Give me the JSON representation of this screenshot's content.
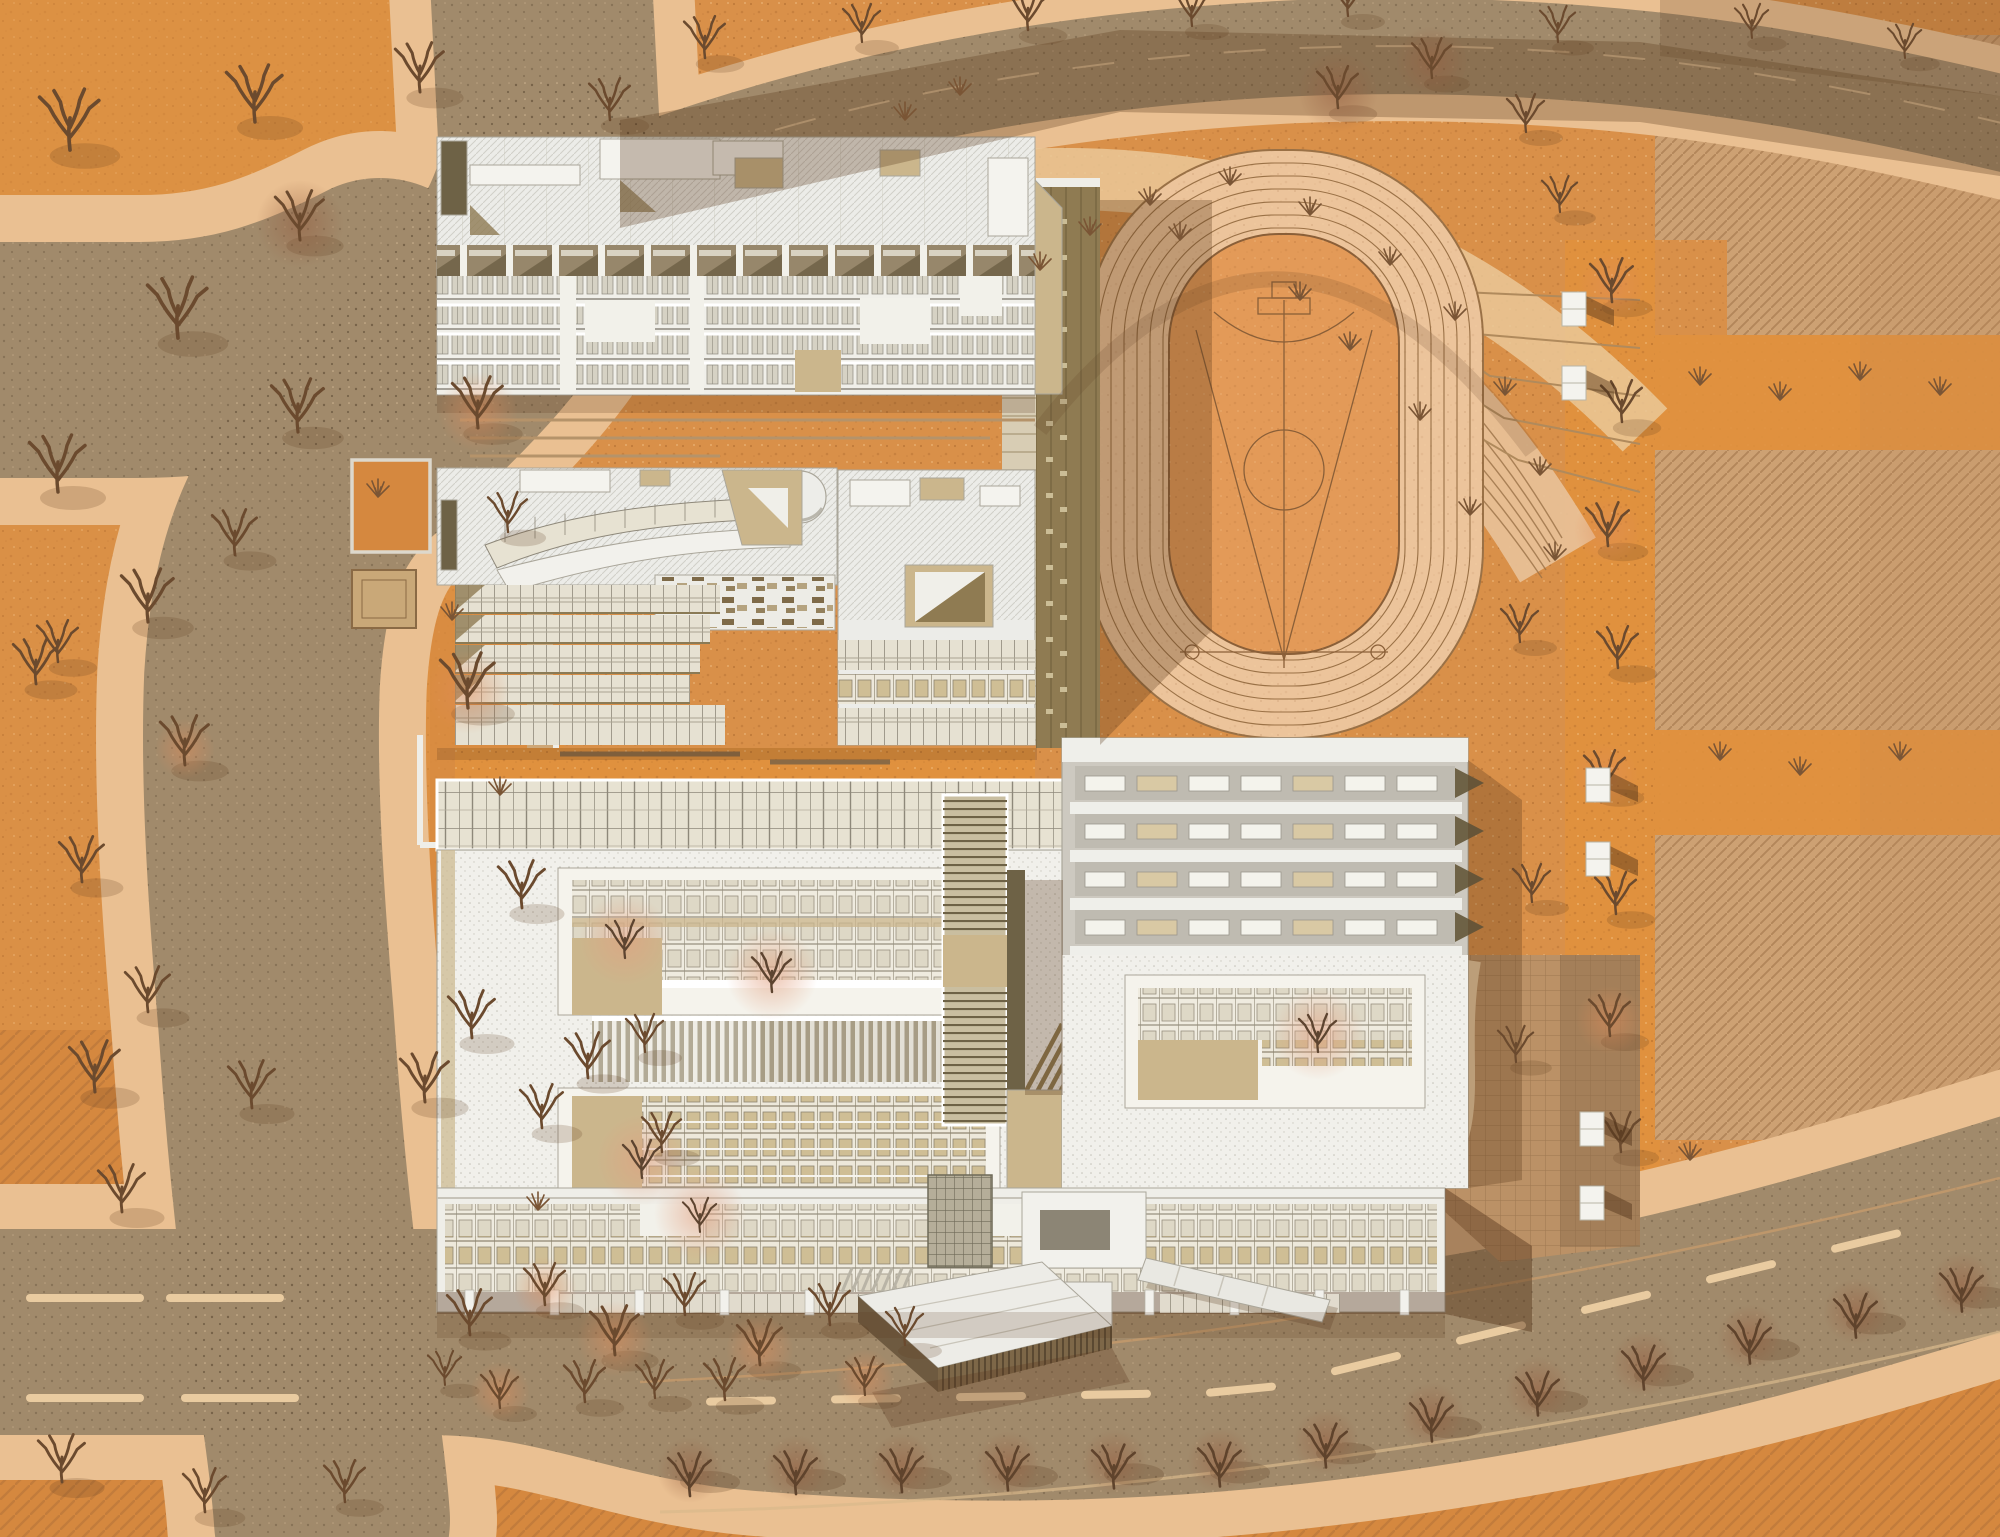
{
  "meta": {
    "label": "Aerial axonometric site plan of a school campus in autumn",
    "canvas": {
      "width": 2000,
      "height": 1537
    },
    "style": "architectural rendering, top-down, warm autumn palette, no visible text"
  },
  "palette": {
    "ground": "#D99049",
    "orchard_bright": "#E0913E",
    "orchard_deep": "#D5883F",
    "road": "#A18A6B",
    "sidewalk": "#EAC092",
    "curb": "#C69A6C",
    "lane_dash": "#E9CBA0",
    "track_surface": "#ECC49B",
    "track_line": "#9A7146",
    "field_infill": "#E39A58",
    "field_line": "#8A5F38",
    "hatch_base": "#CDA173",
    "hatch_line": "#AC7F53",
    "roof_white": "#ECECE8",
    "roof_line": "#AAA69A",
    "gravel": "#F1F0EB",
    "khaki": "#8F7B52",
    "khaki_dark": "#6E6246",
    "tan": "#CBB68C",
    "glass": "#E7E2D2",
    "glass_line": "#8E887A",
    "branch": "#6B4A2E",
    "shadow": "rgba(88,55,28,0.30)",
    "bench": "#F4F3EE"
  },
  "site": {
    "track": {
      "lanes": 7,
      "orientation": "vertical",
      "infield_markings": [
        "center line",
        "center circle",
        "throw sector V",
        "D-arc",
        "throw circles"
      ]
    },
    "gym_roof_monitor_rows": 4,
    "gym_windows_per_row": 7,
    "roads": [
      "west road with X-intersection",
      "north diagonal road",
      "south boulevard with street trees"
    ],
    "buildings": [
      "dormitory slab",
      "library with curved skylight",
      "teaching complex with two courtyards",
      "gymnasium wing",
      "entrance pavilion"
    ]
  },
  "features": [
    {
      "id": "ground",
      "label": "speckled orange ground"
    },
    {
      "id": "hatched-farmland",
      "label": "diagonal hatched field plots (east)"
    },
    {
      "id": "orchard",
      "label": "orchard blocks with bare trees"
    },
    {
      "id": "road-network",
      "label": "taupe roads with peach sidewalks"
    },
    {
      "id": "running-track",
      "label": "7-lane running track with orange infield"
    },
    {
      "id": "amphitheater",
      "label": "terraced steps around track head"
    },
    {
      "id": "grandstand",
      "label": "khaki stand and ramps west of track"
    },
    {
      "id": "dormitory-building",
      "label": "long dormitory slab with cellular facade"
    },
    {
      "id": "library-building",
      "label": "building with curved glass roof band"
    },
    {
      "id": "teaching-complex",
      "label": "main complex with sunken courtyards"
    },
    {
      "id": "gymnasium-building",
      "label": "gym with sawtooth roof monitors"
    },
    {
      "id": "entrance-pavilion",
      "label": "angular entry pavilion with slatted wall"
    },
    {
      "id": "tree-icon",
      "label": "bare deciduous tree glyph"
    },
    {
      "id": "shrub-icon",
      "label": "multi-stem shrub glyph"
    },
    {
      "id": "bench",
      "label": "white bench block"
    }
  ]
}
